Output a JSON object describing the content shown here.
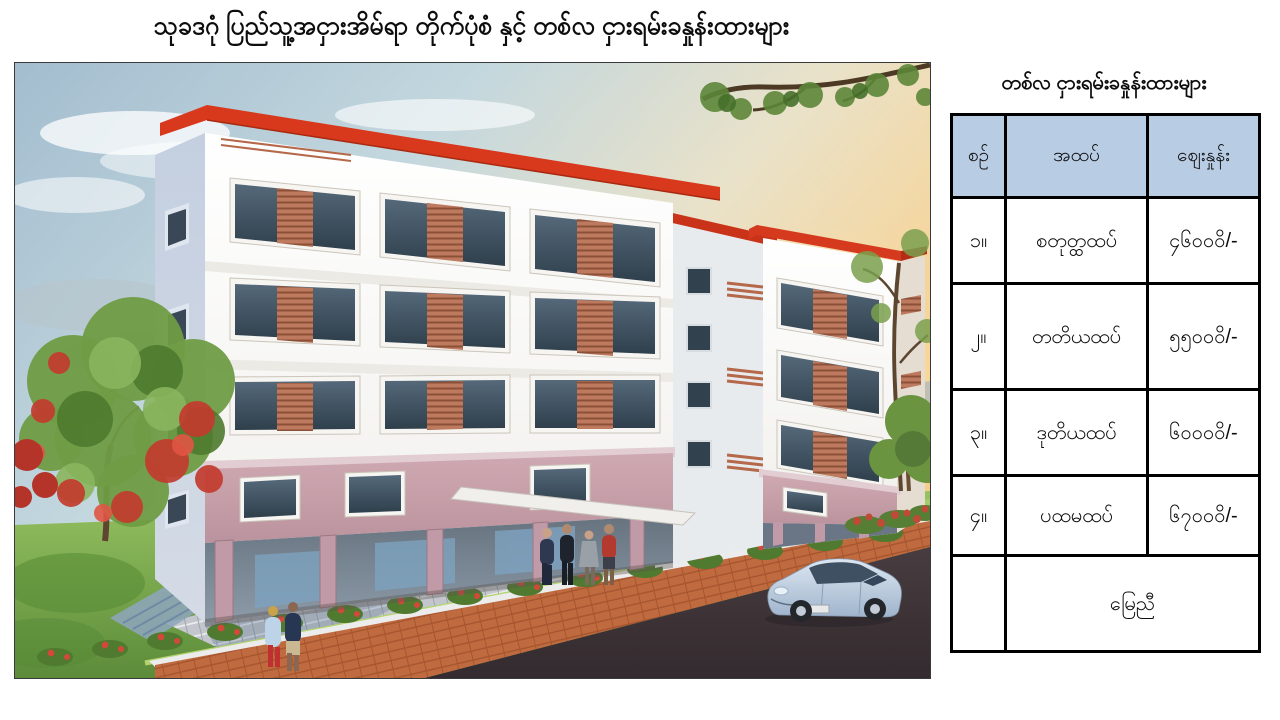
{
  "page": {
    "title": "သုခဒဂုံ ပြည်သူ့အငှားအိမ်ရာ တိုက်ပုံစံ နှင့် တစ်လ ငှားရမ်းခနှုန်းထားများ"
  },
  "illustration": {
    "subject": "3D rendering of 5-level public rental housing block with red roof trim, white upper floors, pink first floor, open ground-floor columns, trees, pedestrians and a car on the road",
    "colors": {
      "roof_red": "#d8391d",
      "wall_white": "#ffffff",
      "wall_pink": "#c7a2ac",
      "louver_terracotta": "#bd7a5e",
      "road_dark": "#3d3439",
      "sidewalk_brick": "#c06b3f"
    }
  },
  "rates": {
    "title": "တစ်လ ငှားရမ်းခနှုန်းထားများ",
    "header_bg": "#b8cce4",
    "columns": [
      "စဉ်",
      "အထပ်",
      "ဈေးနှုန်း"
    ],
    "rows": [
      {
        "no": "၁။",
        "floor": "စတုတ္ထထပ်",
        "price": "၄၆၀၀ဝိ/-"
      },
      {
        "no": "၂။",
        "floor": "တတိယထပ်",
        "price": "၅၅၀၀ဝိ/-"
      },
      {
        "no": "၃။",
        "floor": "ဒုတိယထပ်",
        "price": "၆၀၀၀ဝိ/-"
      },
      {
        "no": "၄။",
        "floor": "ပထမထပ်",
        "price": "၆၇၀၀ဝိ/-"
      }
    ],
    "footer_row": {
      "no": "",
      "label": "မြေညီ"
    }
  }
}
